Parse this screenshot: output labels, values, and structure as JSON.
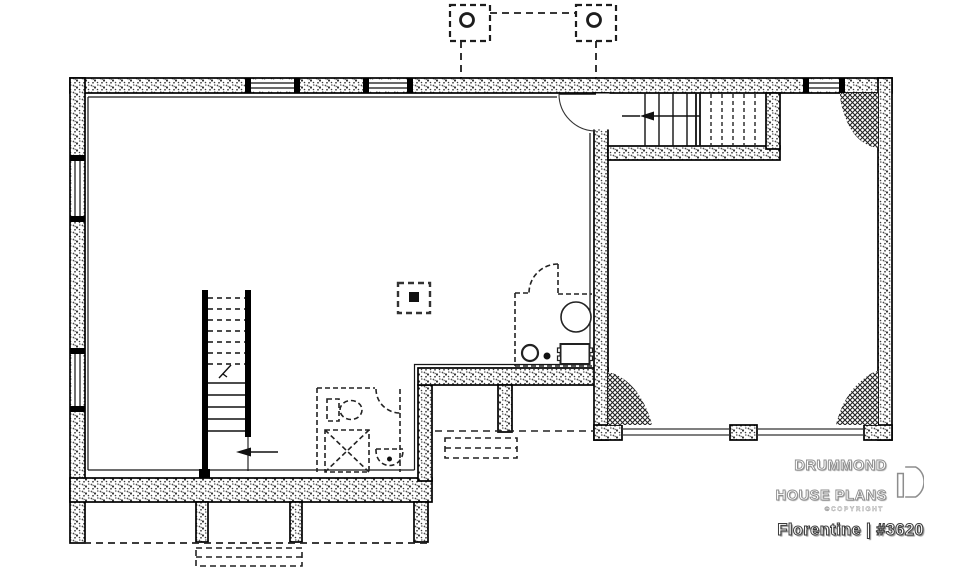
{
  "canvas": {
    "width": 960,
    "height": 569,
    "background": "#ffffff",
    "line_color": "#111111"
  },
  "branding": {
    "name_line1": "DRUMMOND",
    "name_line2": "HOUSE PLANS",
    "copyright": "©COPYRIGHT",
    "logo_icon": "drummond-d-logo"
  },
  "plan": {
    "title": "Florentine | #3620",
    "name": "Florentine",
    "number": "#3620"
  },
  "floorplan": {
    "type": "basement-foundation-plan",
    "features": [
      "concrete-foundation-walls",
      "basement-windows",
      "upper-flight-stairwell",
      "central-staircase",
      "future-bathroom",
      "toilet",
      "shower",
      "sink",
      "mechanical-room",
      "water-heater",
      "laundry-tub",
      "floor-drain",
      "structural-post",
      "garage-foundation",
      "garage-door-opening",
      "backfill-corner-hatch",
      "porch-piers",
      "deck-posts-above",
      "steps-outline"
    ]
  }
}
